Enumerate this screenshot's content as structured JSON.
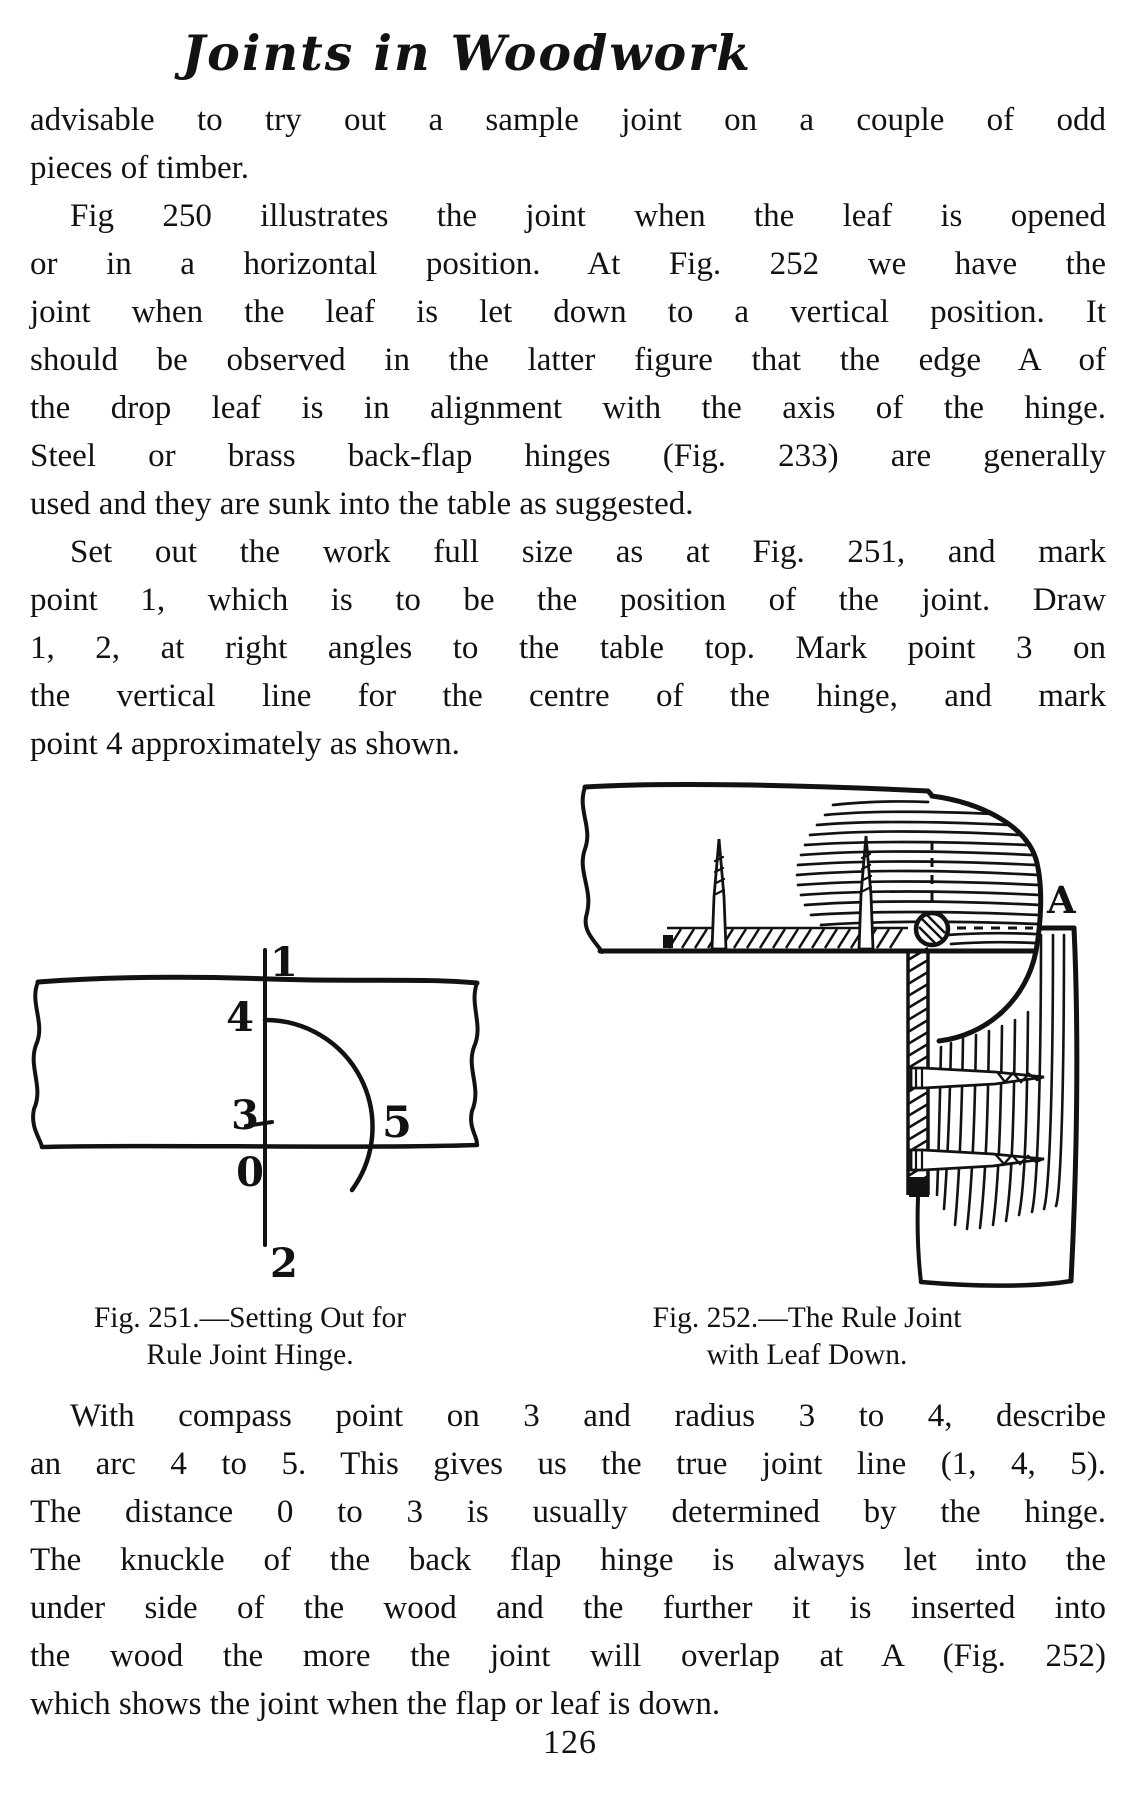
{
  "page": {
    "title": "Joints in Woodwork",
    "page_number": "126",
    "ink": "#121212",
    "paper": "#ffffff"
  },
  "paragraphs": {
    "p1": {
      "lines": [
        "advisable to try out a sample joint on a couple of odd",
        "pieces of timber."
      ]
    },
    "p2": {
      "lines": [
        "Fig 250 illustrates the joint when the leaf is opened",
        "or in a horizontal position.  At Fig. 252 we have the",
        "joint when the leaf is let down to a vertical position.  It",
        "should be observed in the latter figure that the edge A of",
        "the drop leaf is in alignment with the axis of the hinge.",
        "Steel or brass back-flap hinges (Fig. 233) are generally",
        "used and they are sunk into the table as suggested."
      ]
    },
    "p3": {
      "lines": [
        "Set out the work full size as at Fig. 251, and mark",
        "point 1, which is to be the position of the joint.  Draw",
        "1, 2, at right angles to the table top.  Mark point 3 on",
        "the vertical line for the centre of the hinge, and mark",
        "point 4 approximately as shown."
      ]
    },
    "p4": {
      "lines": [
        "With compass point on 3 and radius 3 to 4, describe",
        "an arc 4 to 5.  This gives us the true joint line (1, 4, 5).",
        "The distance 0 to 3 is usually determined by the hinge.",
        "The knuckle of the back flap hinge is always let into the",
        "under side of the wood and the further it is inserted into",
        "the wood the more the joint will overlap at A (Fig. 252)",
        "which shows the joint when the flap or leaf is down."
      ]
    }
  },
  "figures": {
    "fig251": {
      "caption": [
        "Fig. 251.—Setting Out for",
        "Rule Joint Hinge."
      ],
      "points": {
        "p1": "1",
        "p2": "2",
        "p3": "3",
        "p4": "4",
        "p5": "5",
        "p0": "0"
      }
    },
    "fig252": {
      "caption": [
        "Fig. 252.—The Rule Joint",
        "with Leaf Down."
      ],
      "labels": {
        "edge": "A"
      }
    }
  }
}
